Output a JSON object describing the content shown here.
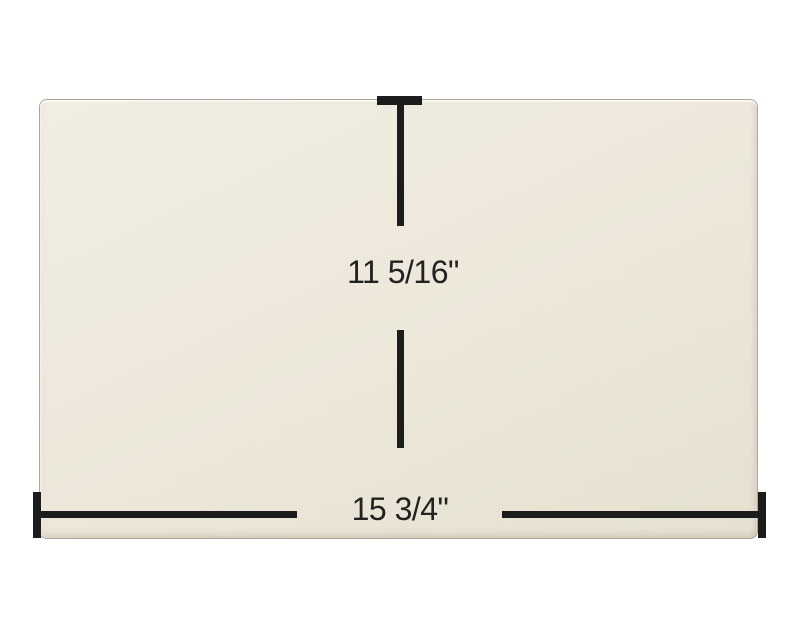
{
  "scene": {
    "background": "#FFFFFF"
  },
  "panel": {
    "kind": "glass-panel",
    "fill_top": "#F1EDE2",
    "fill_mid": "#ECE7D9",
    "fill_bottom": "#E5E0D0",
    "edge_color": "#ABA695"
  },
  "dimensions": {
    "line_color": "#1C1C1C",
    "text_color": "#222222",
    "height_label": "11 5/16\"",
    "width_label": "15 3/4\""
  }
}
